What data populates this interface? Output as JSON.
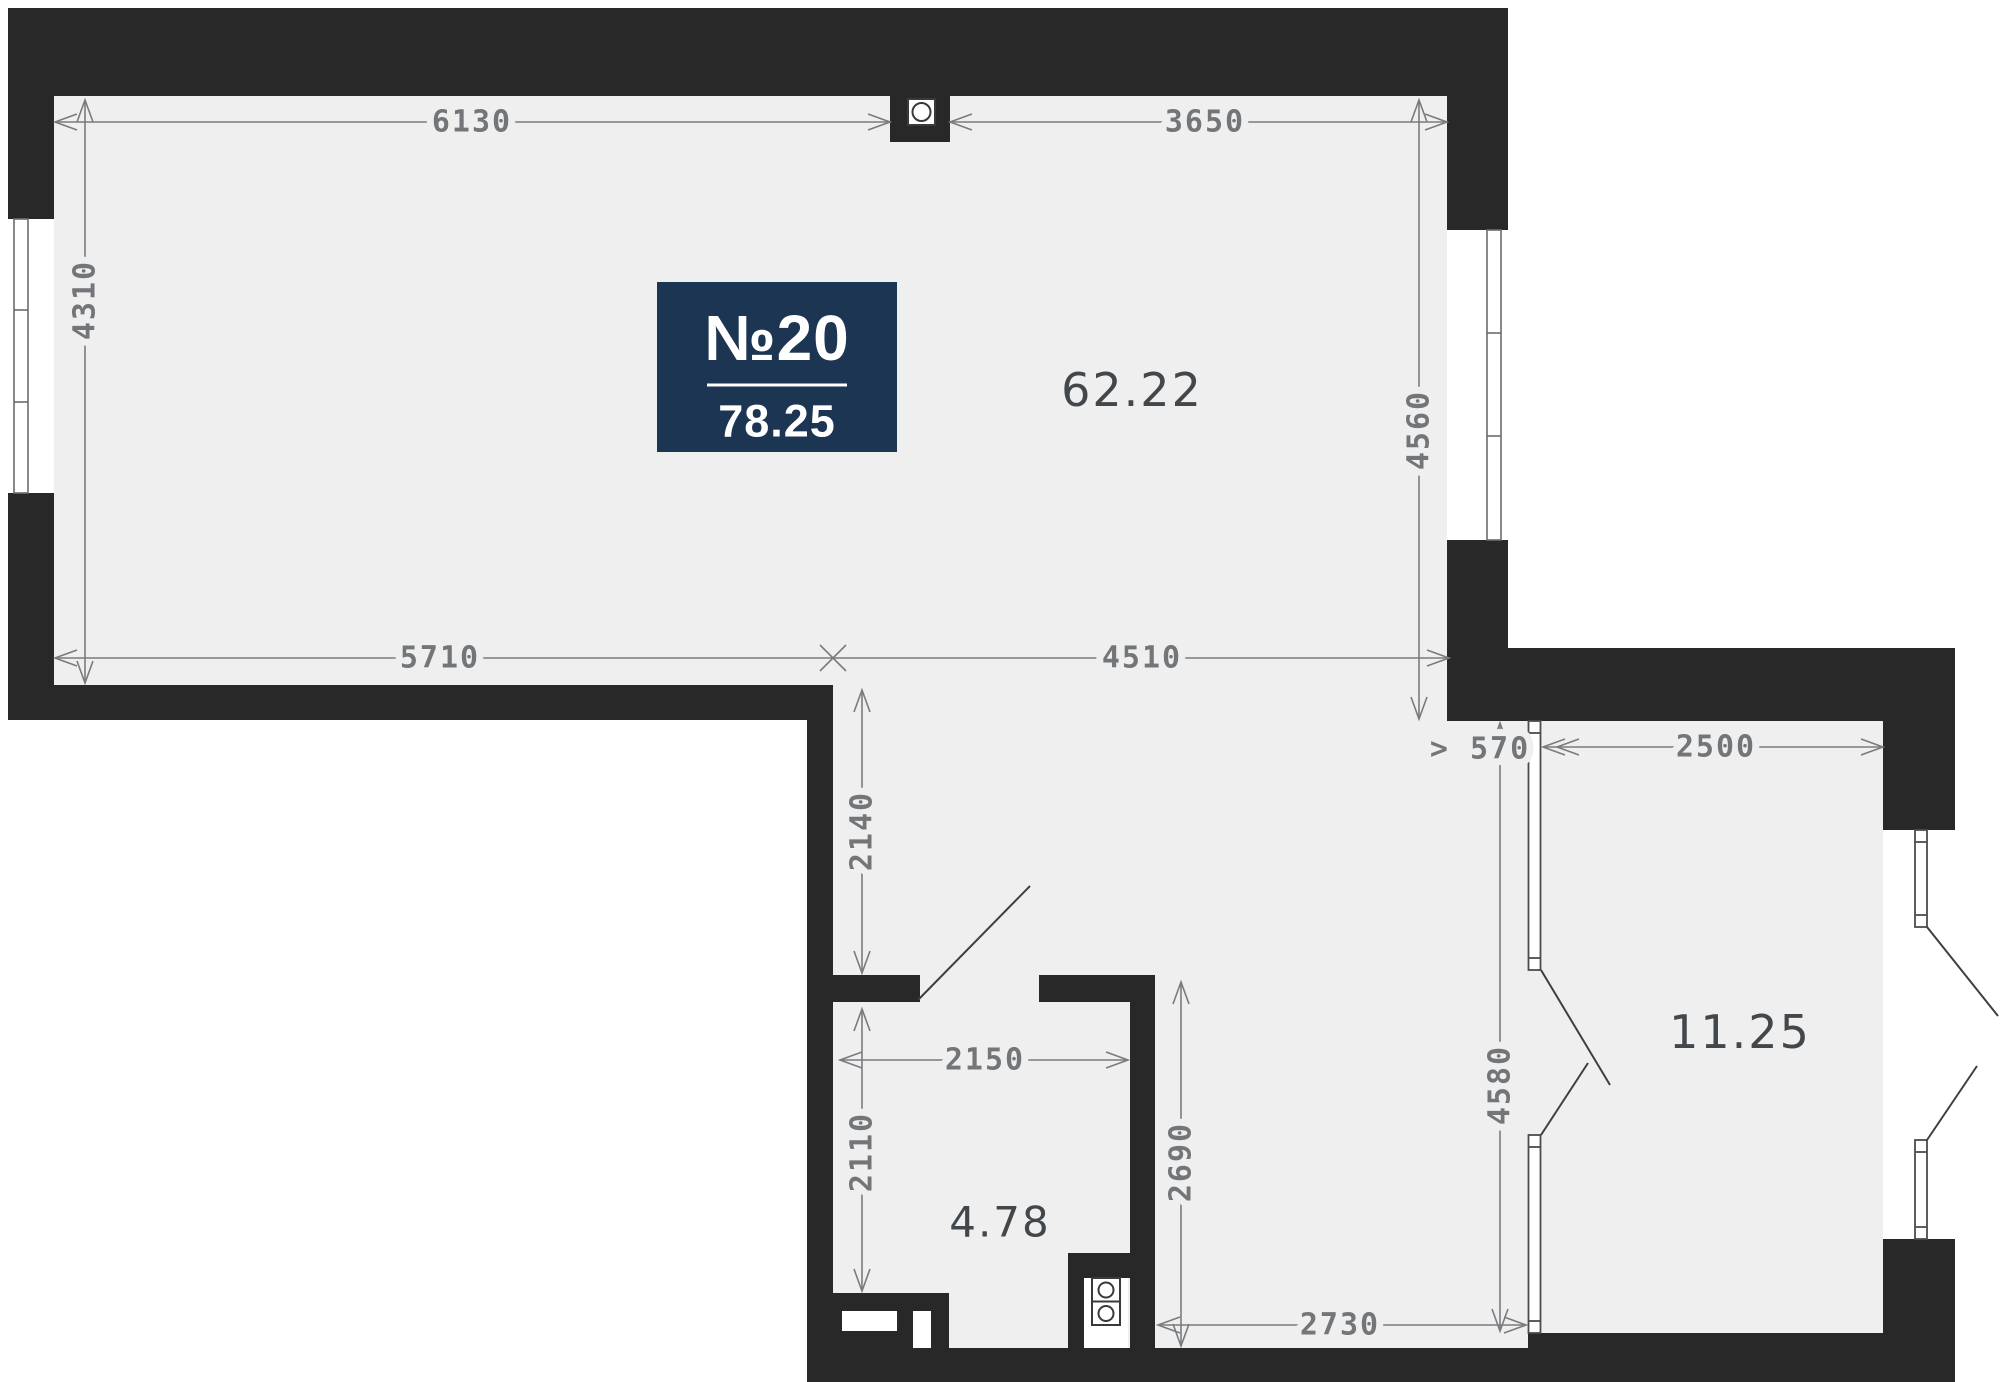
{
  "plan": {
    "badge": {
      "number": "№20",
      "total_area": "78.25"
    },
    "rooms": {
      "main_area": "62.22",
      "bedroom_area": "11.25",
      "bathroom_area": "4.78"
    },
    "dims": {
      "d6130": "6130",
      "d3650": "3650",
      "d4310": "4310",
      "d4560": "4560",
      "d5710": "5710",
      "d4510": "4510",
      "d2140": "2140",
      "d2110": "2110",
      "d2150": "2150",
      "d2690": "2690",
      "d2730": "2730",
      "d4580": "4580",
      "d570": "> 570",
      "d2500": "2500"
    },
    "colors": {
      "wall": "#282828",
      "floor": "#efefef",
      "badge_bg": "#1c3553",
      "dimension_text": "#737679",
      "room_label": "#42474c",
      "background": "#ffffff"
    }
  }
}
